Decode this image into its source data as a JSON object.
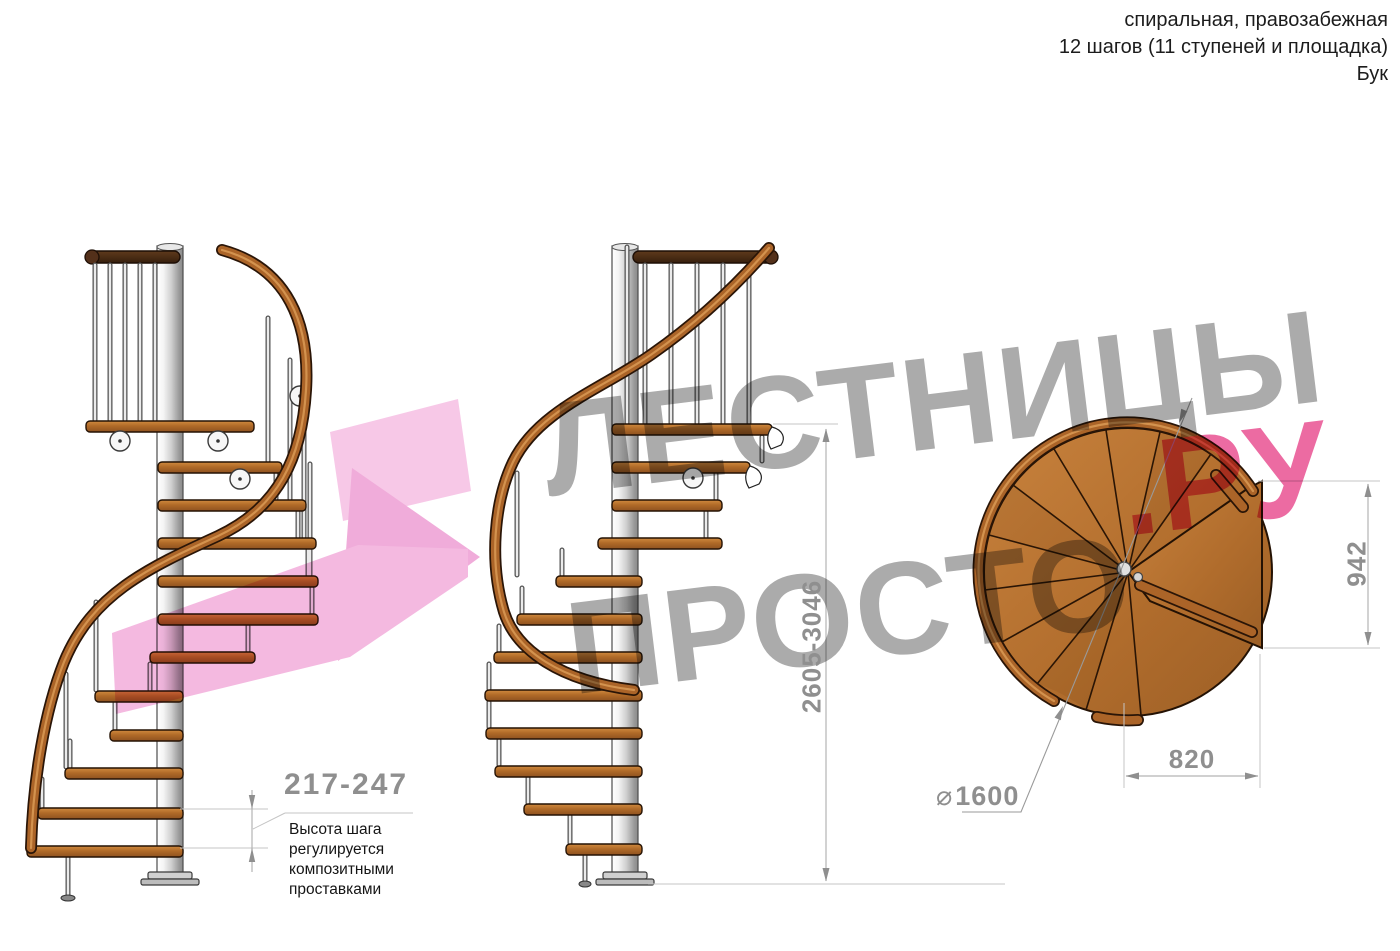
{
  "header": {
    "line1": "спиральная, правозабежная",
    "line2": "12 шагов (11 ступеней и площадка)",
    "line3": "Бук"
  },
  "watermark": {
    "word1": "ЛЕСТНИЦЫ",
    "word2": "ПРОСТО",
    "word2_suffix": ".РУ"
  },
  "annotations": {
    "step_height": {
      "value": "217-247",
      "note": "Высота шага\nрегулируется\nкомпозитными\nпроставками"
    },
    "total_height": "2605-3046",
    "plan_depth": "942",
    "plan_width": "820",
    "diameter": {
      "symbol": "⌀",
      "value": "1600"
    }
  },
  "colors": {
    "wood": "#b06a28",
    "dark_rail": "#42260f",
    "metal_pole": "#cfcfcf",
    "dimension_gray": "#8f8f8f",
    "watermark_gray": "#ababab",
    "brand_pink": "#ec6ba2",
    "arrow_pink": "#f2aedd"
  }
}
